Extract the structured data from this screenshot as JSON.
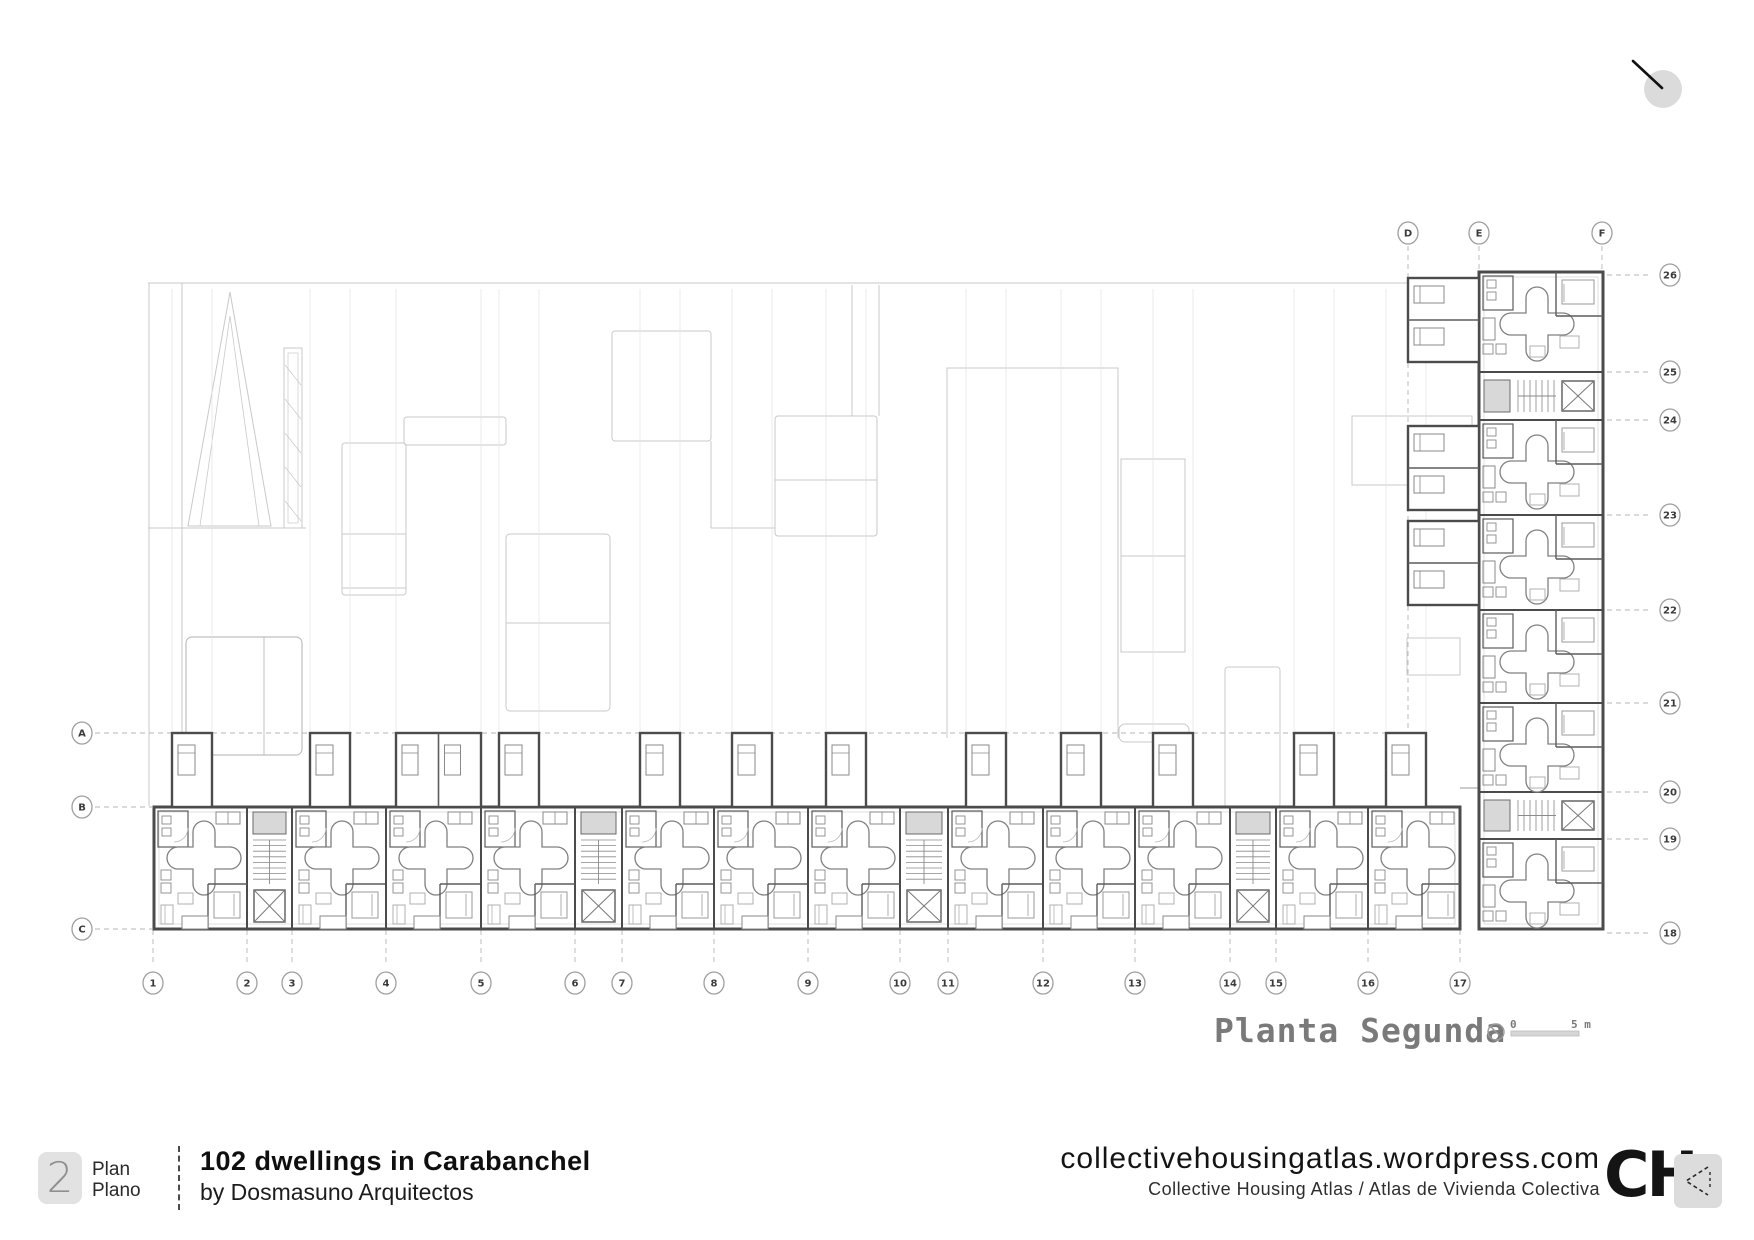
{
  "plan": {
    "title": "Planta Segunda",
    "scale_bar": {
      "start_label": "0",
      "end_label": "5 m",
      "north_icon": "compass-icon"
    },
    "grid": {
      "left": [
        {
          "label": "A",
          "y": 733
        },
        {
          "label": "B",
          "y": 807
        },
        {
          "label": "C",
          "y": 929
        }
      ],
      "top": [
        {
          "label": "D",
          "x": 1408
        },
        {
          "label": "E",
          "x": 1479
        },
        {
          "label": "F",
          "x": 1602
        }
      ],
      "bottom": [
        {
          "label": "1",
          "x": 153
        },
        {
          "label": "2",
          "x": 247
        },
        {
          "label": "3",
          "x": 292
        },
        {
          "label": "4",
          "x": 386
        },
        {
          "label": "5",
          "x": 481
        },
        {
          "label": "6",
          "x": 575
        },
        {
          "label": "7",
          "x": 622
        },
        {
          "label": "8",
          "x": 714
        },
        {
          "label": "9",
          "x": 808
        },
        {
          "label": "10",
          "x": 900
        },
        {
          "label": "11",
          "x": 948
        },
        {
          "label": "12",
          "x": 1043
        },
        {
          "label": "13",
          "x": 1135
        },
        {
          "label": "14",
          "x": 1230
        },
        {
          "label": "15",
          "x": 1276
        },
        {
          "label": "16",
          "x": 1368
        },
        {
          "label": "17",
          "x": 1460
        }
      ],
      "right": [
        {
          "label": "26",
          "y": 275
        },
        {
          "label": "25",
          "y": 372
        },
        {
          "label": "24",
          "y": 420
        },
        {
          "label": "23",
          "y": 515
        },
        {
          "label": "22",
          "y": 610
        },
        {
          "label": "21",
          "y": 703
        },
        {
          "label": "20",
          "y": 792
        },
        {
          "label": "19",
          "y": 839
        },
        {
          "label": "18",
          "y": 933
        }
      ]
    }
  },
  "cursor": {
    "icon": "pointer-circle-icon"
  },
  "footer": {
    "badge_number": "2",
    "badge_label_en": "Plan",
    "badge_label_es": "Plano",
    "project_title": "102 dwellings in Carabanchel",
    "project_byline": "by Dosmasuno Arquitectos",
    "site_url": "collectivehousingatlas.wordpress.com",
    "site_subtitle": "Collective Housing Atlas / Atlas de Vivienda Colectiva",
    "logo_text": "CH",
    "back_icon": "chevron-left-icon"
  },
  "colors": {
    "wall": "#4b4b4b",
    "partition": "#5c5c5c",
    "detail": "#8a8a8a",
    "furniture": "#a8a8a8",
    "overlay": "#c9c9c9",
    "grid": "#b5b5b5",
    "shaft_fill": "#d8d8d8",
    "title_gray": "#7a7a7a",
    "badge_bg": "#e2e2e2",
    "icon_bg": "#dcdcdc",
    "ink": "#141414"
  }
}
